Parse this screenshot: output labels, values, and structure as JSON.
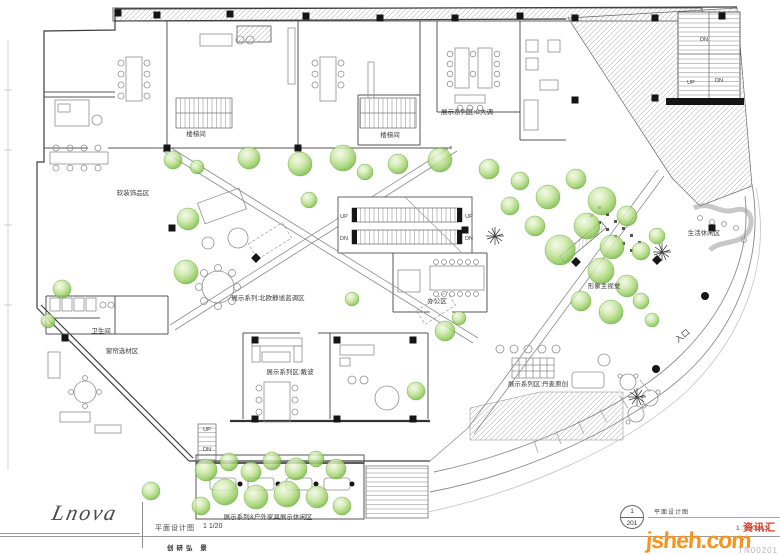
{
  "colors": {
    "tree_green": "#63ab31",
    "column_black": "#151515",
    "wall_gray": "#3c3c3c",
    "line_gray": "#8f8f8f",
    "watermark_orange": "#f7941e",
    "watermark_red": "#e8391d"
  },
  "footer": {
    "logo_text": "Lnova",
    "drawing_title": "平面设计图",
    "drawing_scale_note": "1 1/20",
    "credit_line": "创研弘  景",
    "sheet_number_top": "1",
    "sheet_number_bottom": "201",
    "sheet_title": "平面设计图",
    "sheet_scale": "1 : 200 (A3)",
    "watermark_brand": "jsheh",
    "watermark_domain": ".com",
    "watermark_badge": "资讯汇",
    "watermark_code": "TN00201"
  },
  "plan": {
    "labels": [
      {
        "t": "楼梯间",
        "x": 196,
        "y": 136
      },
      {
        "t": "楼梯间",
        "x": 390,
        "y": 137
      },
      {
        "t": "展示系列区:C大调",
        "x": 467,
        "y": 114
      },
      {
        "t": "软装饰品区",
        "x": 133,
        "y": 195
      },
      {
        "t": "卫生间",
        "x": 101,
        "y": 333
      },
      {
        "t": "窗帘选材区",
        "x": 122,
        "y": 353
      },
      {
        "t": "展示系列:北欧静谧蓝调区",
        "x": 268,
        "y": 300
      },
      {
        "t": "办公区",
        "x": 437,
        "y": 303
      },
      {
        "t": "形象主视觉",
        "x": 604,
        "y": 288
      },
      {
        "t": "生活休闲区",
        "x": 704,
        "y": 235
      },
      {
        "t": "入口",
        "x": 684,
        "y": 338,
        "r": -38,
        "s": 8
      },
      {
        "t": "展示系列区:戴波",
        "x": 290,
        "y": 374
      },
      {
        "t": "展示系列区:丹麦原创",
        "x": 538,
        "y": 386
      },
      {
        "t": "展示系列&户外家具展示休闲区",
        "x": 268,
        "y": 519
      },
      {
        "t": "UP",
        "x": 344,
        "y": 218,
        "s": 5.5
      },
      {
        "t": "UP",
        "x": 469,
        "y": 218,
        "s": 5.5
      },
      {
        "t": "DN",
        "x": 344,
        "y": 240,
        "s": 5.5
      },
      {
        "t": "DN",
        "x": 469,
        "y": 240,
        "s": 5.5
      },
      {
        "t": "DN",
        "x": 704,
        "y": 41,
        "s": 5.5
      },
      {
        "t": "UP",
        "x": 691,
        "y": 84,
        "s": 5.5
      },
      {
        "t": "DN",
        "x": 719,
        "y": 82,
        "s": 5.5
      },
      {
        "t": "UP",
        "x": 207,
        "y": 431,
        "s": 5.5
      },
      {
        "t": "DN",
        "x": 207,
        "y": 451,
        "s": 5.5
      }
    ],
    "columns": [
      [
        118,
        13
      ],
      [
        157,
        15
      ],
      [
        230,
        14
      ],
      [
        306,
        16
      ],
      [
        380,
        18
      ],
      [
        455,
        18
      ],
      [
        520,
        16
      ],
      [
        575,
        18
      ],
      [
        655,
        18
      ],
      [
        722,
        16
      ],
      [
        575,
        100
      ],
      [
        655,
        98
      ],
      [
        172,
        228
      ],
      [
        465,
        230
      ],
      [
        712,
        228
      ],
      [
        256,
        258,
        45
      ],
      [
        576,
        262,
        45
      ],
      [
        657,
        260,
        45
      ],
      [
        65,
        338
      ],
      [
        255,
        340
      ],
      [
        337,
        340
      ],
      [
        413,
        340
      ],
      [
        255,
        419
      ],
      [
        337,
        419
      ],
      [
        413,
        419
      ],
      [
        167,
        148
      ],
      [
        298,
        148
      ]
    ],
    "trees": [
      [
        173,
        160,
        9
      ],
      [
        197,
        167,
        7
      ],
      [
        249,
        158,
        11
      ],
      [
        300,
        164,
        12
      ],
      [
        343,
        158,
        13
      ],
      [
        365,
        172,
        8
      ],
      [
        398,
        164,
        10
      ],
      [
        440,
        160,
        12
      ],
      [
        489,
        169,
        10
      ],
      [
        520,
        181,
        9
      ],
      [
        548,
        197,
        12
      ],
      [
        576,
        179,
        10
      ],
      [
        602,
        201,
        14
      ],
      [
        627,
        216,
        10
      ],
      [
        587,
        226,
        13
      ],
      [
        560,
        250,
        15
      ],
      [
        612,
        247,
        12
      ],
      [
        641,
        251,
        9
      ],
      [
        657,
        236,
        8
      ],
      [
        601,
        271,
        13
      ],
      [
        627,
        286,
        11
      ],
      [
        581,
        301,
        10
      ],
      [
        611,
        312,
        12
      ],
      [
        641,
        301,
        8
      ],
      [
        535,
        226,
        10
      ],
      [
        510,
        206,
        9
      ],
      [
        652,
        320,
        7
      ],
      [
        309,
        200,
        8
      ],
      [
        188,
        219,
        11
      ],
      [
        186,
        272,
        12
      ],
      [
        352,
        299,
        7
      ],
      [
        445,
        331,
        10
      ],
      [
        459,
        318,
        7
      ],
      [
        416,
        391,
        9
      ],
      [
        62,
        289,
        9
      ],
      [
        48,
        321,
        7
      ],
      [
        151,
        491,
        9
      ],
      [
        206,
        470,
        11
      ],
      [
        229,
        462,
        9
      ],
      [
        251,
        472,
        10
      ],
      [
        272,
        461,
        9
      ],
      [
        296,
        469,
        11
      ],
      [
        316,
        459,
        8
      ],
      [
        336,
        469,
        10
      ],
      [
        225,
        492,
        13
      ],
      [
        256,
        497,
        12
      ],
      [
        287,
        494,
        13
      ],
      [
        317,
        497,
        11
      ],
      [
        201,
        506,
        9
      ],
      [
        342,
        506,
        9
      ]
    ],
    "glass_dots": [
      [
        705,
        296
      ],
      [
        656,
        369
      ]
    ],
    "scribble_plants": [
      [
        495,
        236
      ],
      [
        662,
        252
      ],
      [
        637,
        397
      ]
    ]
  }
}
